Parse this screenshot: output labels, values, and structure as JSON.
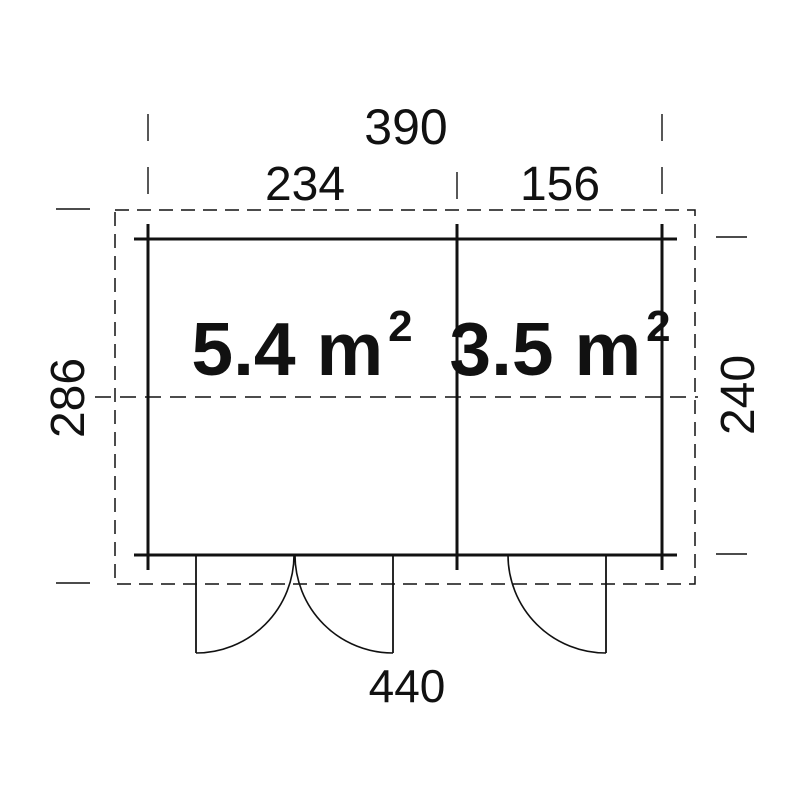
{
  "floor_plan": {
    "colors": {
      "line": "#111111",
      "background": "#ffffff"
    },
    "dims": {
      "overall_width": "390",
      "left_section_width": "234",
      "right_section_width": "156",
      "outer_depth": "286",
      "inner_depth": "240",
      "base_width": "440"
    },
    "rooms": [
      {
        "area": "5.4 m",
        "area_sup": "2"
      },
      {
        "area": "3.5 m",
        "area_sup": "2"
      }
    ]
  }
}
